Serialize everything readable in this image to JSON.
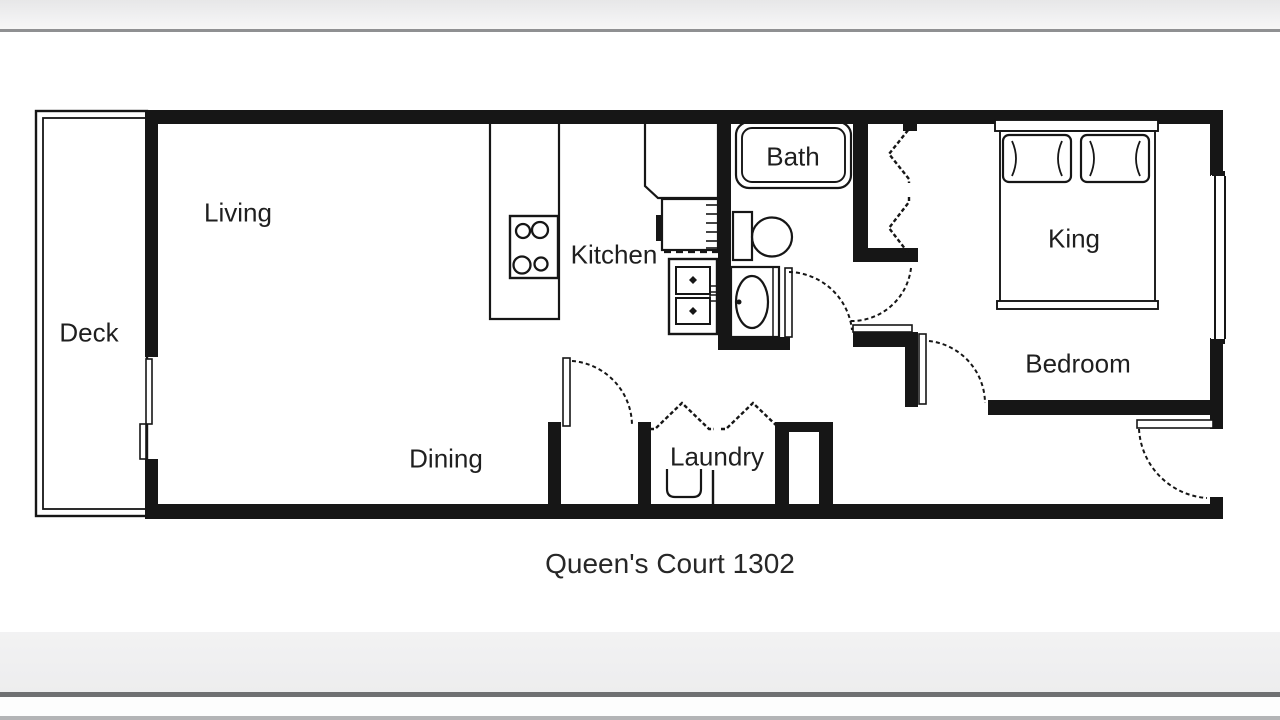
{
  "floor_plan": {
    "title": "Queen's Court 1302",
    "unit_number": "1302",
    "rooms": [
      {
        "id": "deck",
        "label": "Deck"
      },
      {
        "id": "living",
        "label": "Living"
      },
      {
        "id": "kitchen",
        "label": "Kitchen"
      },
      {
        "id": "dining",
        "label": "Dining"
      },
      {
        "id": "laundry",
        "label": "Laundry"
      },
      {
        "id": "bath",
        "label": "Bath"
      },
      {
        "id": "bedroom",
        "label": "Bedroom"
      }
    ],
    "furniture": {
      "king_bed_label": "King"
    },
    "fixtures": [
      "bathtub-icon",
      "toilet-icon",
      "vanity-sink-icon",
      "stove-icon",
      "refrigerator-icon",
      "kitchen-double-sink-icon",
      "kitchen-counter-icon",
      "king-bed-icon",
      "washer-icon",
      "bifold-closet-doors-icon",
      "sliding-glass-door-icon",
      "window-icon",
      "door-swing-icon"
    ],
    "colors": {
      "wall": "#161616",
      "background": "#ffffff",
      "chrome_bar": "#ededee",
      "chrome_dark_line": "#6f7072",
      "chrome_bottom_edge": "#b3b4b6"
    }
  }
}
